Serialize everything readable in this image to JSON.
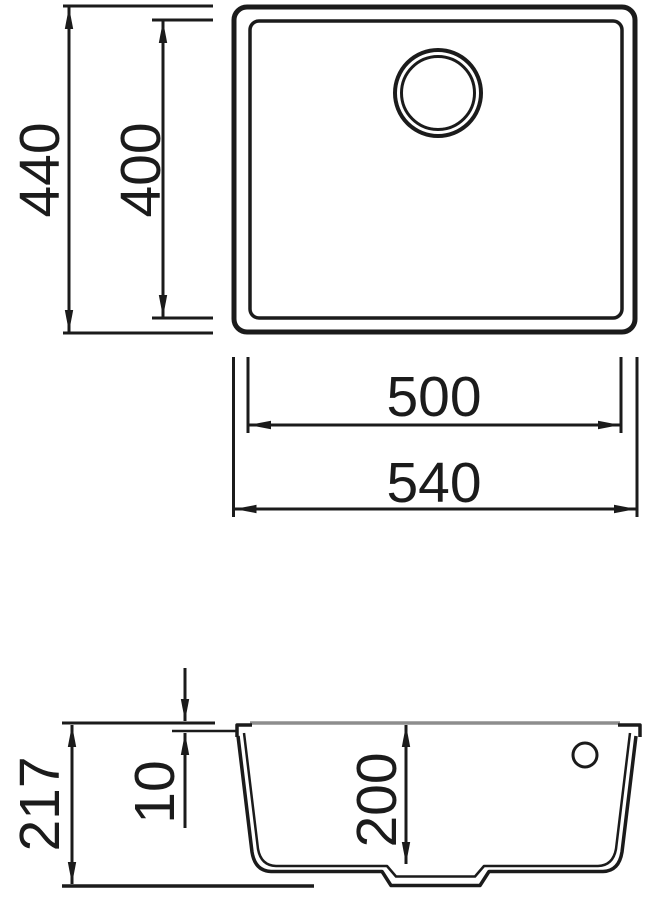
{
  "page": {
    "background": "#ffffff"
  },
  "drawing": {
    "line_color": "#1b1b1b",
    "surface_line_color": "#8d8d8d",
    "top_view": {
      "outer_height": "440",
      "inner_height": "400",
      "inner_width": "500",
      "outer_width": "540"
    },
    "section_view": {
      "total_height": "217",
      "rim_thickness": "10",
      "bowl_depth": "200"
    }
  }
}
